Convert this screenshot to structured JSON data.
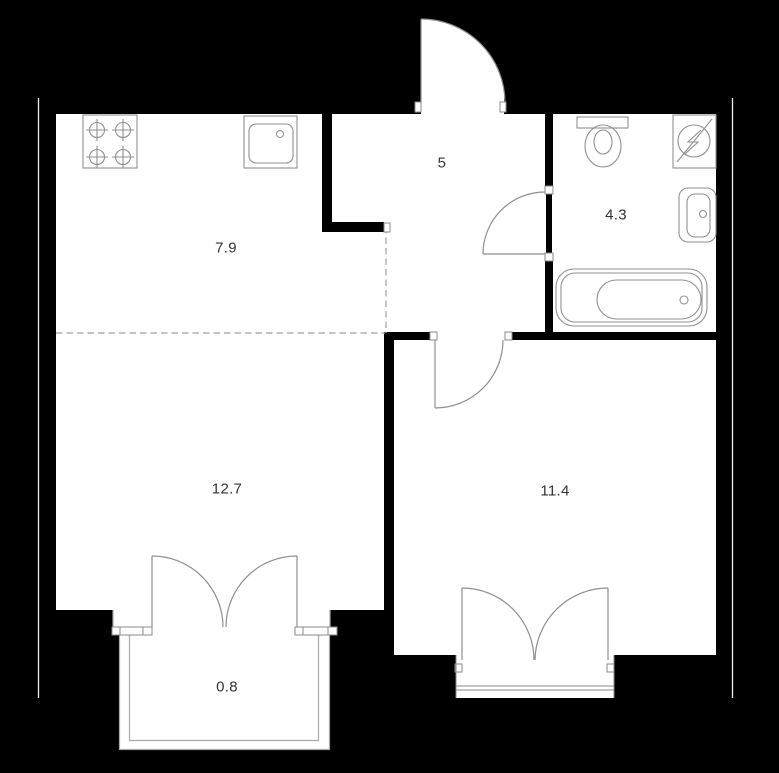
{
  "rooms": {
    "kitchen": {
      "area": "7.9"
    },
    "hallway": {
      "area": "5"
    },
    "bathroom": {
      "area": "4.3"
    },
    "living_room": {
      "area": "12.7"
    },
    "bedroom": {
      "area": "11.4"
    },
    "balcony": {
      "area": "0.8"
    }
  },
  "fixtures": [
    "stove-4-burner",
    "kitchen-sink",
    "toilet",
    "electrical-panel",
    "washbasin",
    "bathtub"
  ],
  "doors": [
    "entrance-door",
    "bathroom-door",
    "bedroom-door",
    "balcony-double-door",
    "bedroom-french-window"
  ],
  "colors": {
    "background": "#000000",
    "floor": "#ffffff",
    "wall": "#000000",
    "fixture_line": "#8f8f8f",
    "outer_boundary_line": "#ededed",
    "dashed_partition": "#a0a0a0",
    "label_text": "#333333"
  }
}
